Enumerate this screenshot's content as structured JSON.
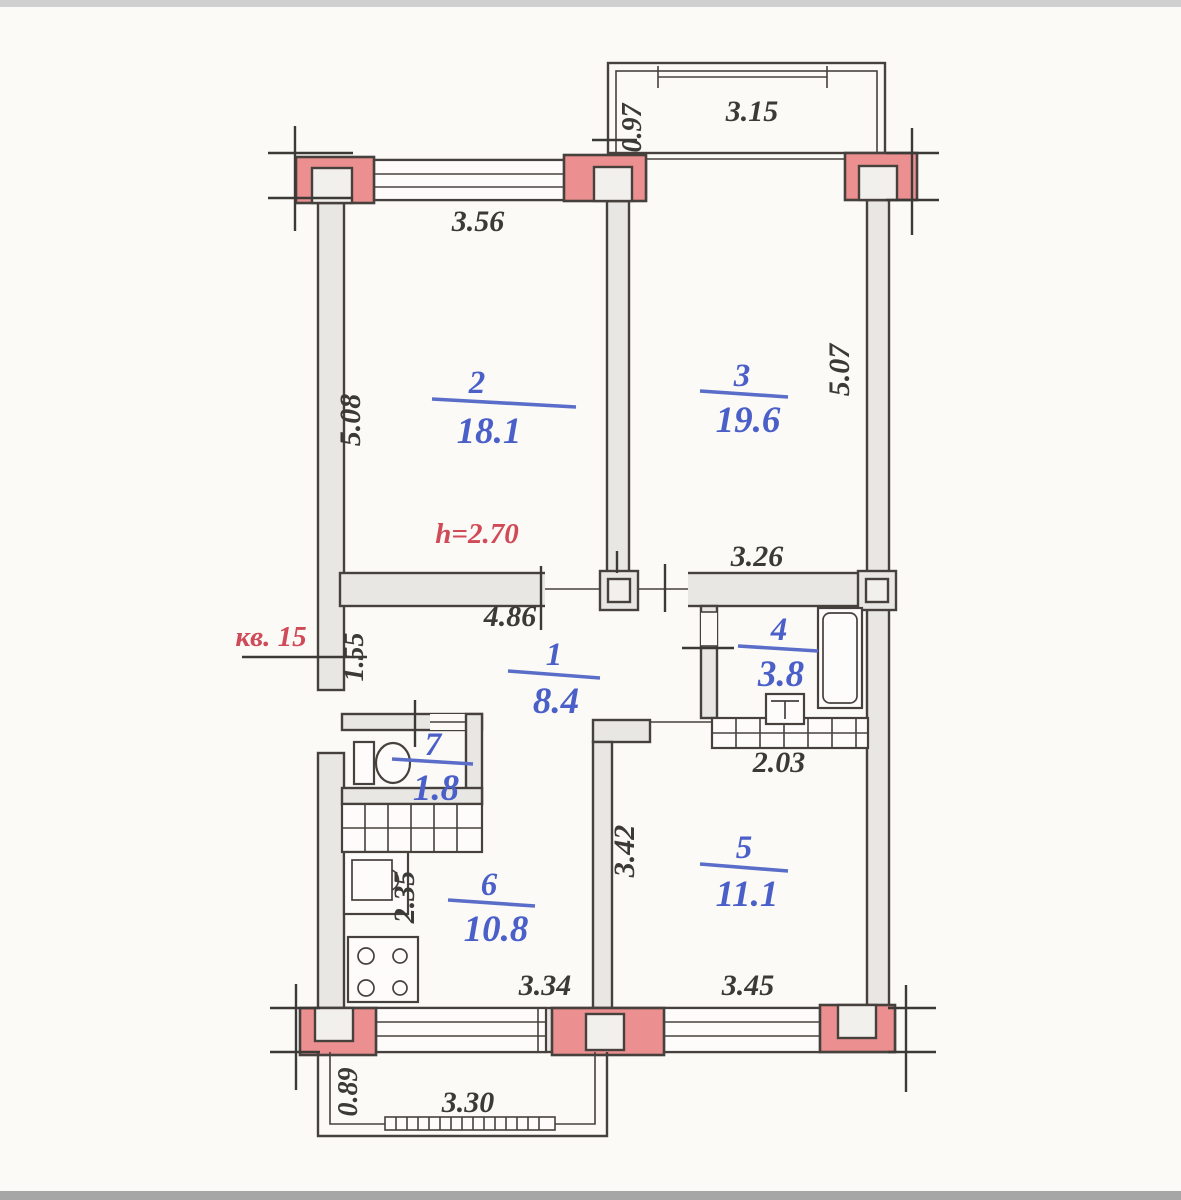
{
  "plan": {
    "annotations": {
      "apartment": "кв. 15",
      "ceiling_height": "h=2.70"
    },
    "rooms": [
      {
        "number": "1",
        "area": "8.4"
      },
      {
        "number": "2",
        "area": "18.1"
      },
      {
        "number": "3",
        "area": "19.6"
      },
      {
        "number": "4",
        "area": "3.8"
      },
      {
        "number": "5",
        "area": "11.1"
      },
      {
        "number": "6",
        "area": "10.8"
      },
      {
        "number": "7",
        "area": "1.8"
      }
    ],
    "dimensions": {
      "top_window": "3.56",
      "top_balcony_width": "3.15",
      "top_balcony_depth": "0.97",
      "left_side": "5.08",
      "right_side": "5.07",
      "room3_bottom": "3.26",
      "hall_top": "4.86",
      "entry_side": "1.55",
      "closet_width": "2.03",
      "room5_side": "3.42",
      "kitchen_side": "2.35",
      "kitchen_bottom": "3.34",
      "room5_bottom": "3.45",
      "bottom_balcony_width": "3.30",
      "bottom_balcony_depth": "0.89"
    },
    "colors": {
      "background": "#fbfaf7",
      "wall_fill": "#e9e7e3",
      "wall_stroke": "#46413d",
      "pilaster_fill": "#ec8f90",
      "room_label": "#4a5fc8",
      "red_label": "#d04a58",
      "dim_label": "#3c3a37"
    }
  }
}
